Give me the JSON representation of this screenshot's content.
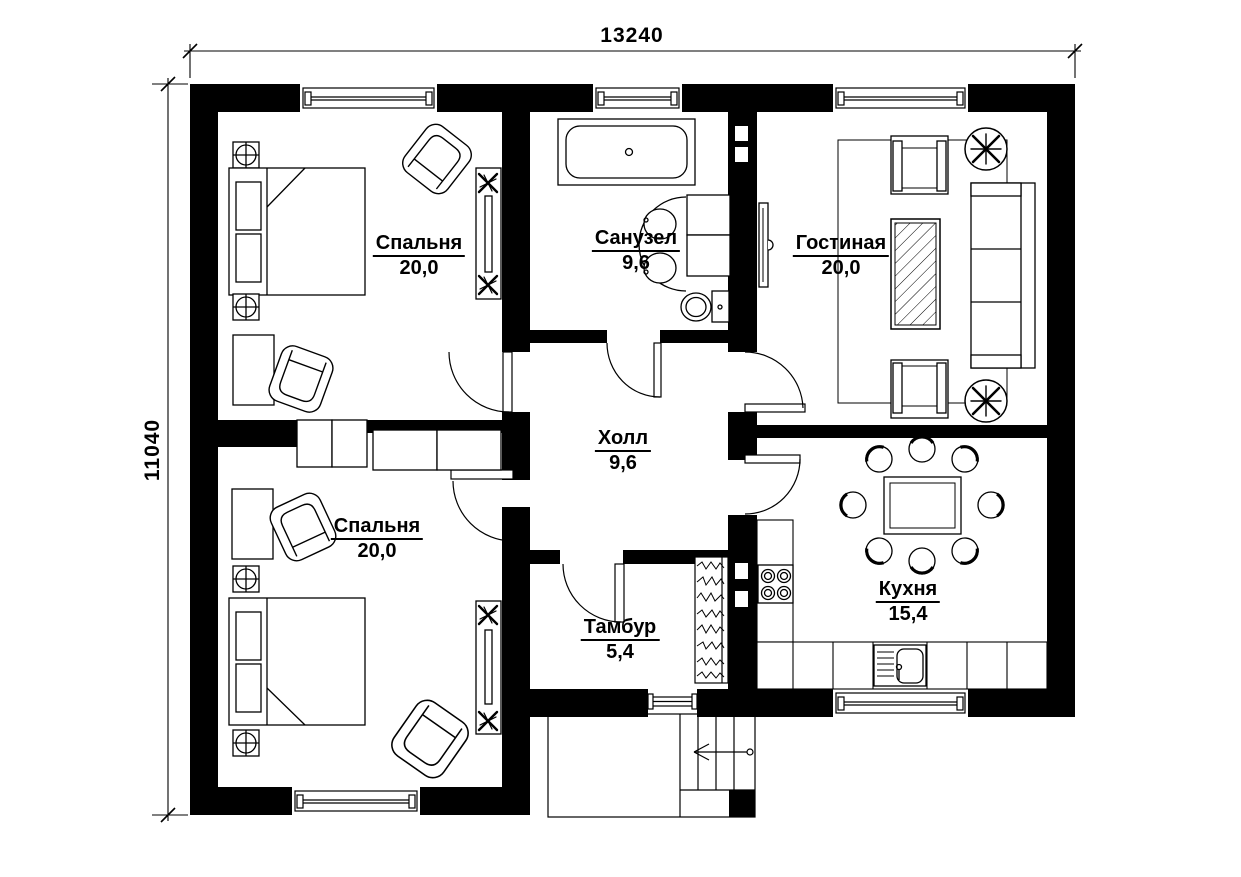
{
  "drawing": {
    "type": "floor-plan",
    "dimensions": {
      "top": "13240",
      "left": "11040"
    },
    "rooms": [
      {
        "key": "bedroom-1",
        "name": "Спальня",
        "area": "20,0"
      },
      {
        "key": "bathroom",
        "name": "Санузел",
        "area": "9,6"
      },
      {
        "key": "living-room",
        "name": "Гостиная",
        "area": "20,0"
      },
      {
        "key": "hall",
        "name": "Холл",
        "area": "9,6"
      },
      {
        "key": "bedroom-2",
        "name": "Спальня",
        "area": "20,0"
      },
      {
        "key": "vestibule",
        "name": "Тамбур",
        "area": "5,4"
      },
      {
        "key": "kitchen",
        "name": "Кухня",
        "area": "15,4"
      }
    ],
    "colors": {
      "ink": "#000000",
      "paper": "#ffffff"
    }
  }
}
